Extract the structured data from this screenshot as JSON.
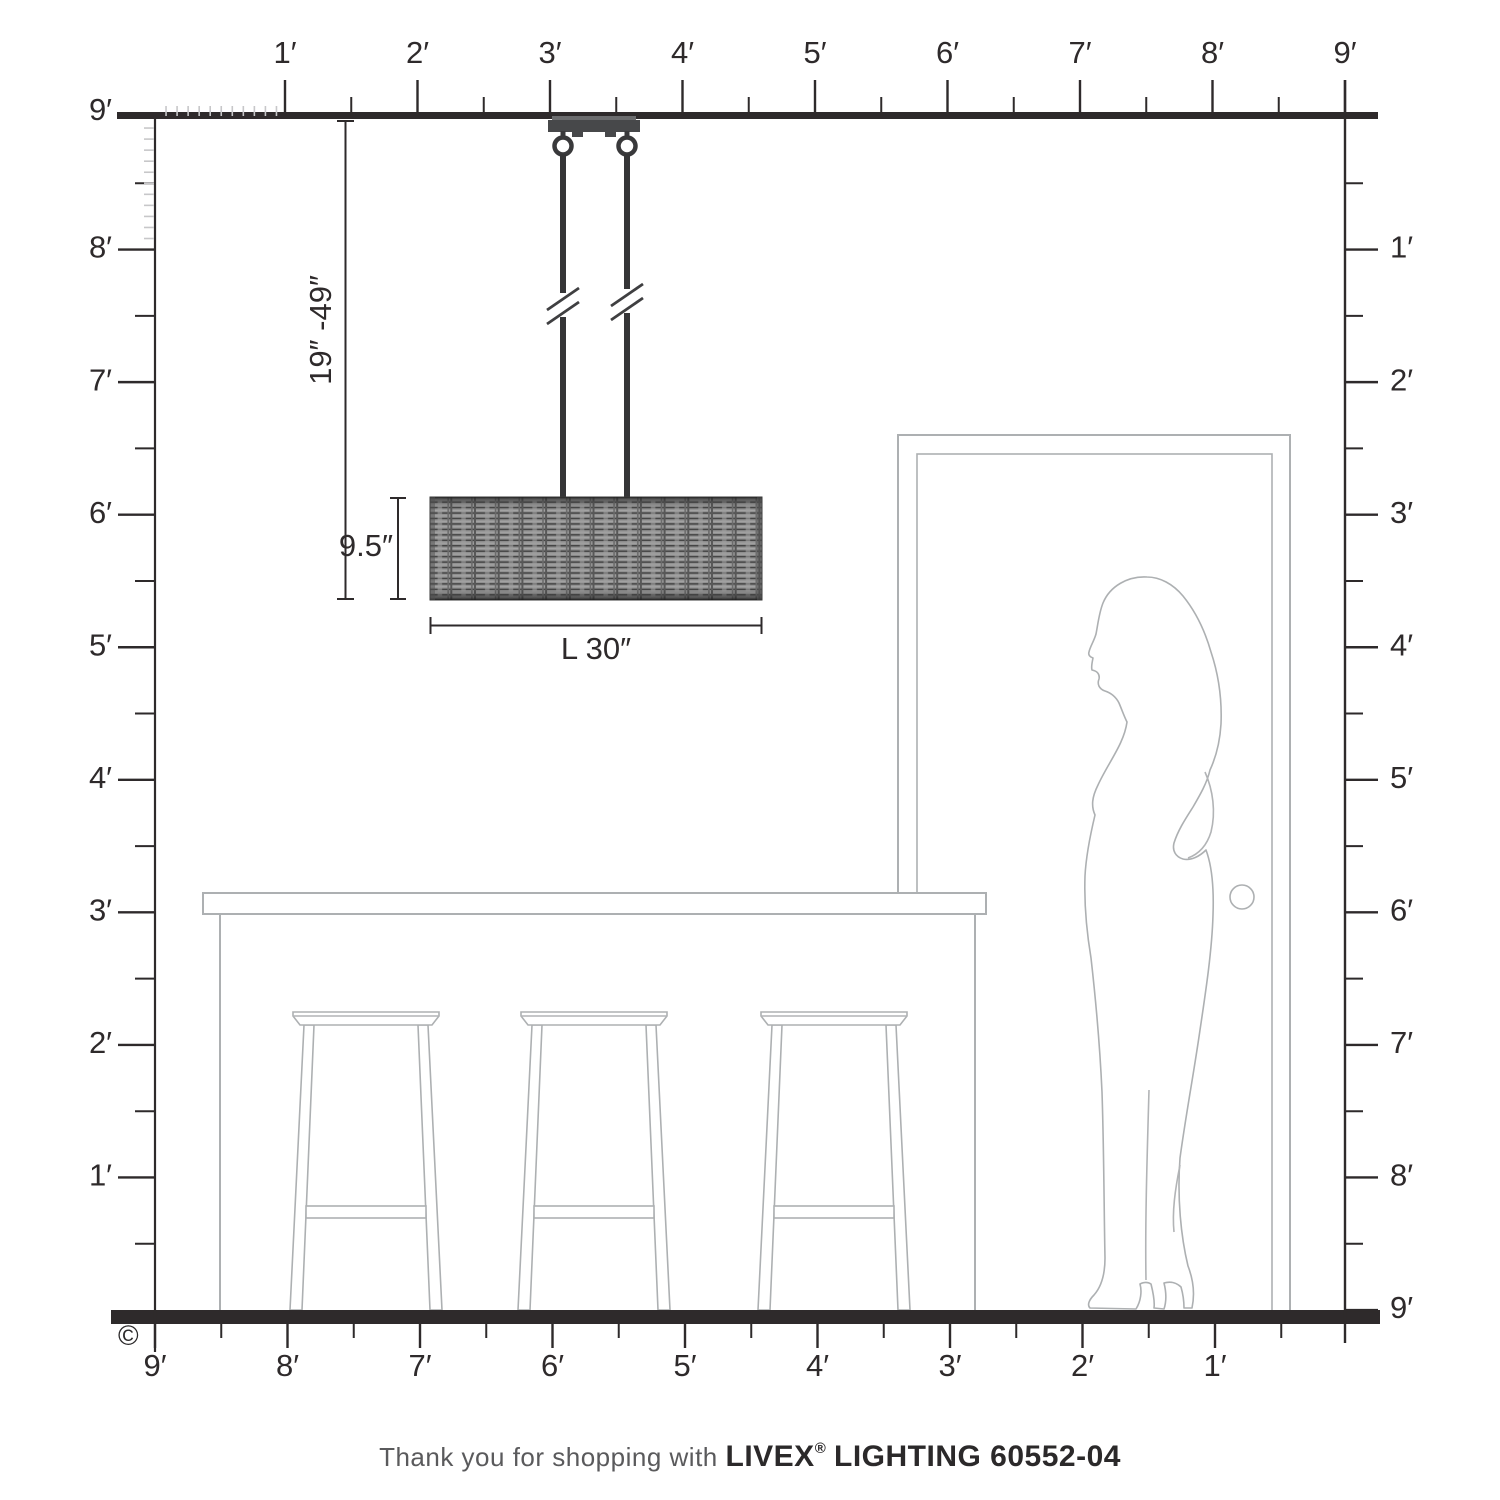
{
  "page": {
    "copyright": "©"
  },
  "rulers": {
    "top": {
      "labels": [
        "1′",
        "2′",
        "3′",
        "4′",
        "5′",
        "6′",
        "7′",
        "8′",
        "9′"
      ]
    },
    "left": {
      "labels": [
        "9′",
        "8′",
        "7′",
        "6′",
        "5′",
        "4′",
        "3′",
        "2′",
        "1′"
      ]
    },
    "right": {
      "labels": [
        "1′",
        "2′",
        "3′",
        "4′",
        "5′",
        "6′",
        "7′",
        "8′",
        "9′"
      ]
    },
    "bottom": {
      "labels": [
        "9′",
        "8′",
        "7′",
        "6′",
        "5′",
        "4′",
        "3′",
        "2′",
        "1′"
      ]
    }
  },
  "dimensions": {
    "drop": "19″ -49″",
    "shade_height": "9.5″",
    "shade_width": "L 30″"
  },
  "footer": {
    "thanks": "Thank you for shopping with",
    "brand": "LIVEX",
    "reg": "®",
    "product": "LIGHTING 60552-04"
  },
  "colors": {
    "ruler_line": "#2e2a2b",
    "furniture_outline": "#adb0b2",
    "fixture_dark": "#454547",
    "wicker_base": "#909090",
    "muted_text": "#5a5a5c"
  }
}
